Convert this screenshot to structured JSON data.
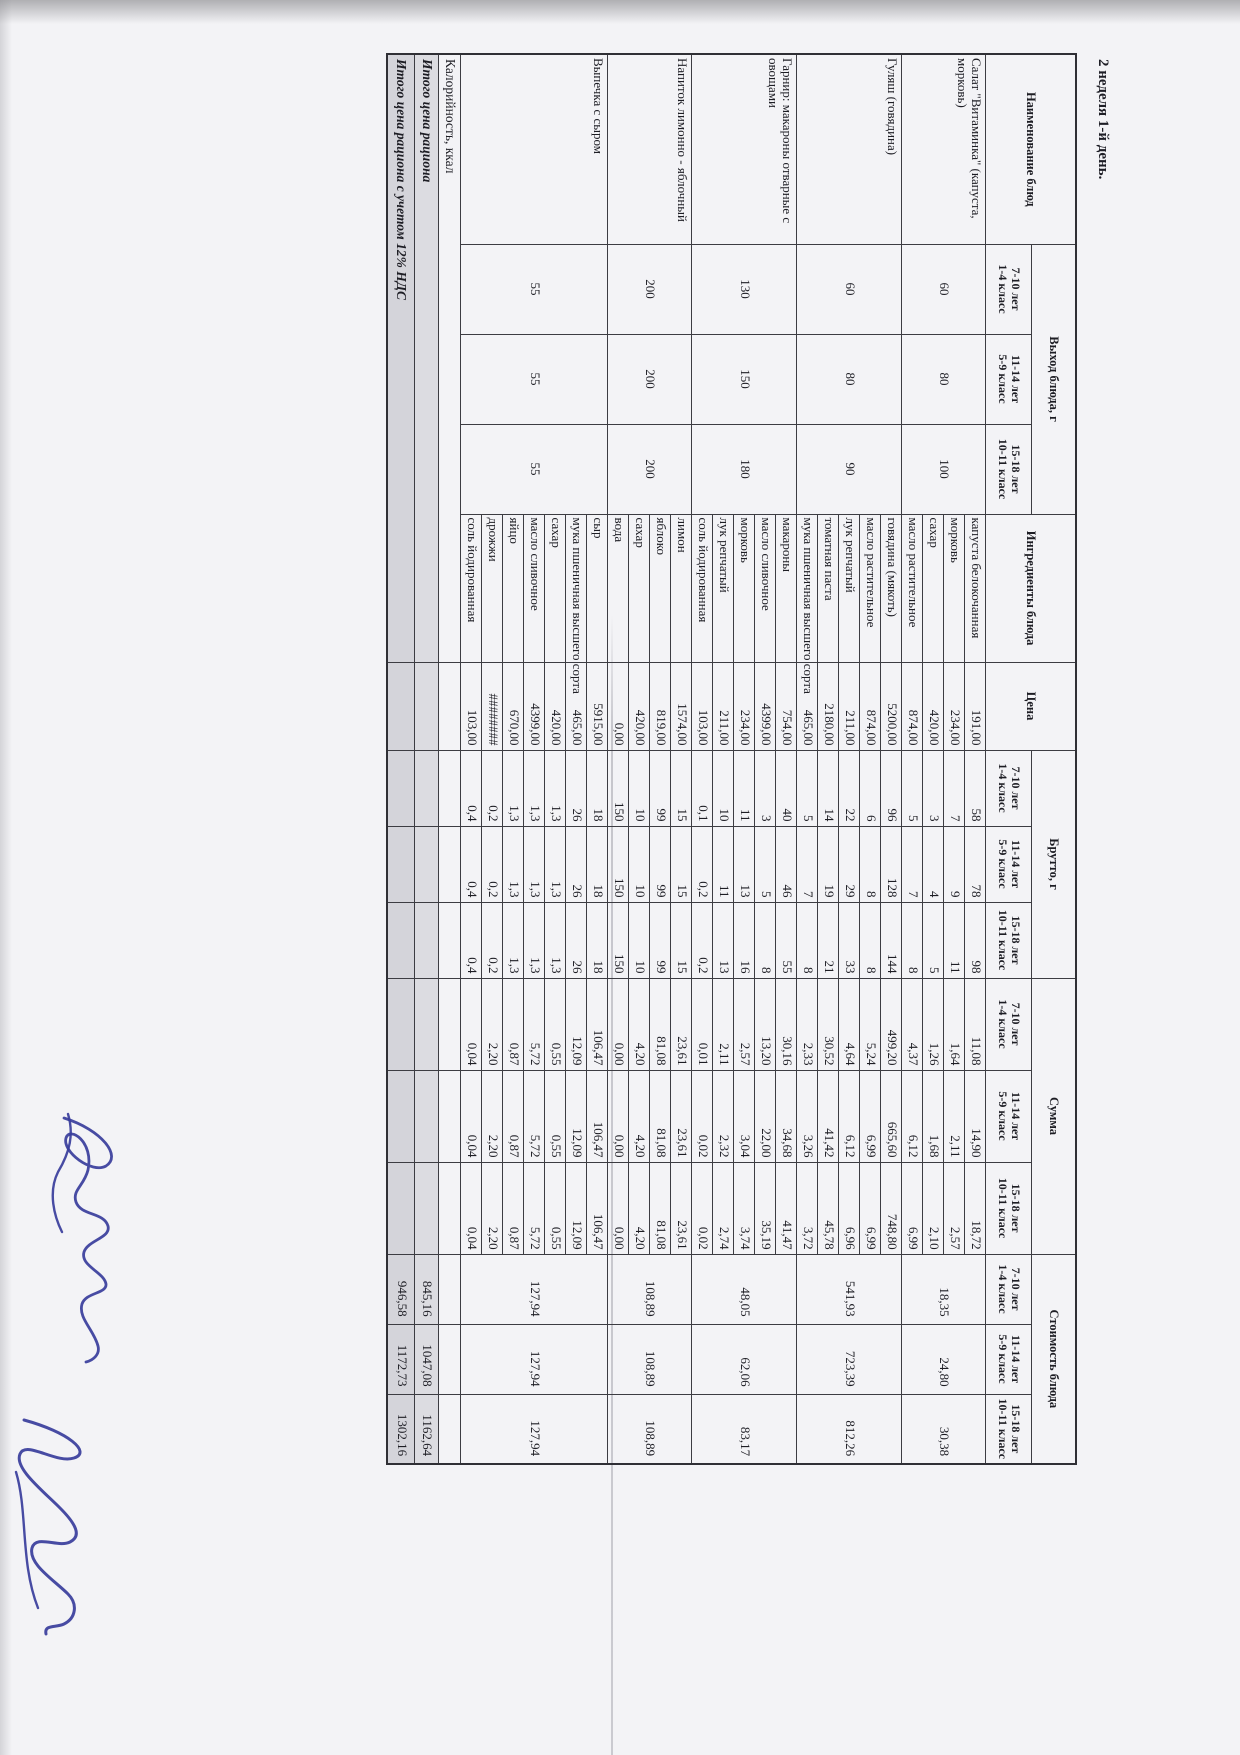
{
  "page": {
    "title": "2 неделя 1-й день."
  },
  "scan": {
    "ink_color": "#383d9b",
    "paper_color": "#f3f3f6",
    "total_row_shade": "#d4d4da"
  },
  "table": {
    "headers": {
      "dish": "Наименование блюд",
      "output_group": "Выход блюда, г",
      "ingredients": "Ингредиенты блюда",
      "price": "Цена",
      "gross_group": "Брутто, г",
      "sum_group": "Сумма",
      "cost_group": "Стоимость блюда",
      "age_classes": [
        "7-10 лет\n1-4 класс",
        "11-14 лет\n5-9 класс",
        "15-18 лет\n10-11 класс"
      ]
    },
    "dishes": [
      {
        "name": "Салат \"Витаминка\" (капуста, морковь)",
        "output": [
          "60",
          "80",
          "100"
        ],
        "cost": [
          "18,35",
          "24,80",
          "30,38"
        ],
        "ingredients": [
          {
            "name": "капуста белокочанная",
            "price": "191,00",
            "gross": [
              "58",
              "78",
              "98"
            ],
            "sum": [
              "11,08",
              "14,90",
              "18,72"
            ]
          },
          {
            "name": "морковь",
            "price": "234,00",
            "gross": [
              "7",
              "9",
              "11"
            ],
            "sum": [
              "1,64",
              "2,11",
              "2,57"
            ]
          },
          {
            "name": "сахар",
            "price": "420,00",
            "gross": [
              "3",
              "4",
              "5"
            ],
            "sum": [
              "1,26",
              "1,68",
              "2,10"
            ]
          },
          {
            "name": "масло растительное",
            "price": "874,00",
            "gross": [
              "5",
              "7",
              "8"
            ],
            "sum": [
              "4,37",
              "6,12",
              "6,99"
            ]
          }
        ]
      },
      {
        "name": "Гуляш (говядина)",
        "output": [
          "60",
          "80",
          "90"
        ],
        "cost": [
          "541,93",
          "723,39",
          "812,26"
        ],
        "ingredients": [
          {
            "name": "говядина (мякоть)",
            "price": "5200,00",
            "gross": [
              "96",
              "128",
              "144"
            ],
            "sum": [
              "499,20",
              "665,60",
              "748,80"
            ]
          },
          {
            "name": "масло растительное",
            "price": "874,00",
            "gross": [
              "6",
              "8",
              "8"
            ],
            "sum": [
              "5,24",
              "6,99",
              "6,99"
            ]
          },
          {
            "name": "лук репчатый",
            "price": "211,00",
            "gross": [
              "22",
              "29",
              "33"
            ],
            "sum": [
              "4,64",
              "6,12",
              "6,96"
            ]
          },
          {
            "name": "томатная паста",
            "price": "2180,00",
            "gross": [
              "14",
              "19",
              "21"
            ],
            "sum": [
              "30,52",
              "41,42",
              "45,78"
            ]
          },
          {
            "name": "мука пшеничная высшего сорта",
            "price": "465,00",
            "gross": [
              "5",
              "7",
              "8"
            ],
            "sum": [
              "2,33",
              "3,26",
              "3,72"
            ]
          }
        ]
      },
      {
        "name": "Гарнир: макароны отварные с овощами",
        "output": [
          "130",
          "150",
          "180"
        ],
        "cost": [
          "48,05",
          "62,06",
          "83,17"
        ],
        "ingredients": [
          {
            "name": "макароны",
            "price": "754,00",
            "gross": [
              "40",
              "46",
              "55"
            ],
            "sum": [
              "30,16",
              "34,68",
              "41,47"
            ]
          },
          {
            "name": "масло сливочное",
            "price": "4399,00",
            "gross": [
              "3",
              "5",
              "8"
            ],
            "sum": [
              "13,20",
              "22,00",
              "35,19"
            ]
          },
          {
            "name": "морковь",
            "price": "234,00",
            "gross": [
              "11",
              "13",
              "16"
            ],
            "sum": [
              "2,57",
              "3,04",
              "3,74"
            ]
          },
          {
            "name": "лук репчатый",
            "price": "211,00",
            "gross": [
              "10",
              "11",
              "13"
            ],
            "sum": [
              "2,11",
              "2,32",
              "2,74"
            ]
          },
          {
            "name": "соль йодированная",
            "price": "103,00",
            "gross": [
              "0,1",
              "0,2",
              "0,2"
            ],
            "sum": [
              "0,01",
              "0,02",
              "0,02"
            ]
          }
        ]
      },
      {
        "name": "Напиток лимонно - яблочный",
        "output": [
          "200",
          "200",
          "200"
        ],
        "cost": [
          "108,89",
          "108,89",
          "108,89"
        ],
        "ingredients": [
          {
            "name": "лимон",
            "price": "1574,00",
            "gross": [
              "15",
              "15",
              "15"
            ],
            "sum": [
              "23,61",
              "23,61",
              "23,61"
            ]
          },
          {
            "name": "яблоко",
            "price": "819,00",
            "gross": [
              "99",
              "99",
              "99"
            ],
            "sum": [
              "81,08",
              "81,08",
              "81,08"
            ]
          },
          {
            "name": "сахар",
            "price": "420,00",
            "gross": [
              "10",
              "10",
              "10"
            ],
            "sum": [
              "4,20",
              "4,20",
              "4,20"
            ]
          },
          {
            "name": "вода",
            "price": "0,00",
            "gross": [
              "150",
              "150",
              "150"
            ],
            "sum": [
              "0,00",
              "0,00",
              "0,00"
            ]
          }
        ]
      },
      {
        "name": "Выпечка с сыром",
        "output": [
          "55",
          "55",
          "55"
        ],
        "cost": [
          "127,94",
          "127,94",
          "127,94"
        ],
        "ingredients": [
          {
            "name": "сыр",
            "price": "5915,00",
            "gross": [
              "18",
              "18",
              "18"
            ],
            "sum": [
              "106,47",
              "106,47",
              "106,47"
            ]
          },
          {
            "name": "мука пшеничная высшего сорта",
            "price": "465,00",
            "gross": [
              "26",
              "26",
              "26"
            ],
            "sum": [
              "12,09",
              "12,09",
              "12,09"
            ]
          },
          {
            "name": "сахар",
            "price": "420,00",
            "gross": [
              "1,3",
              "1,3",
              "1,3"
            ],
            "sum": [
              "0,55",
              "0,55",
              "0,55"
            ]
          },
          {
            "name": "масло сливочное",
            "price": "4399,00",
            "gross": [
              "1,3",
              "1,3",
              "1,3"
            ],
            "sum": [
              "5,72",
              "5,72",
              "5,72"
            ]
          },
          {
            "name": "яйцо",
            "price": "670,00",
            "gross": [
              "1,3",
              "1,3",
              "1,3"
            ],
            "sum": [
              "0,87",
              "0,87",
              "0,87"
            ]
          },
          {
            "name": "дрожжи",
            "price": "########",
            "gross": [
              "0,2",
              "0,2",
              "0,2"
            ],
            "sum": [
              "2,20",
              "2,20",
              "2,20"
            ]
          },
          {
            "name": "соль йодированная",
            "price": "103,00",
            "gross": [
              "0,4",
              "0,4",
              "0,4"
            ],
            "sum": [
              "0,04",
              "0,04",
              "0,04"
            ]
          }
        ]
      }
    ],
    "footer_rows": [
      {
        "label": "Калорийность, ккал",
        "values": [
          "",
          "",
          ""
        ]
      },
      {
        "label": "Итого цена рациона",
        "values": [
          "845,16",
          "1047,08",
          "1162,64"
        ]
      },
      {
        "label": "Итого цена рациона с учетом 12% НДС",
        "values": [
          "946,58",
          "1172,73",
          "1302,16"
        ]
      }
    ]
  }
}
